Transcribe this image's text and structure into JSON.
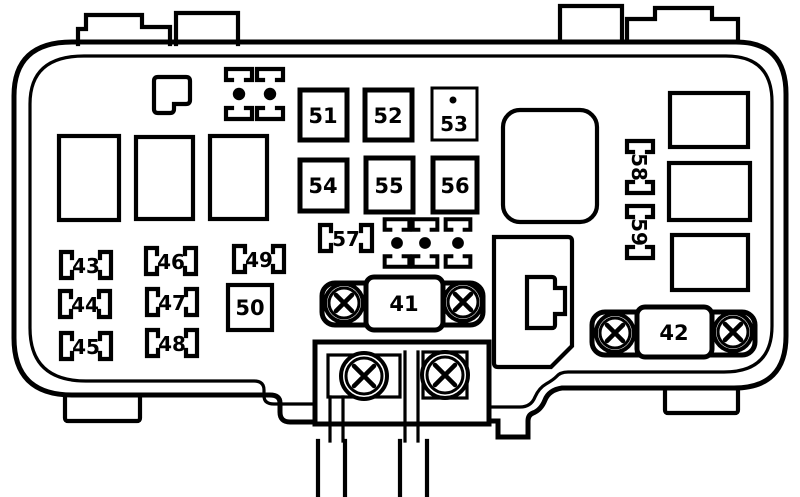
{
  "diagram": {
    "kind": "under-hood fuse and relay box line diagram",
    "line_color": "#000000",
    "background_color": "#ffffff",
    "main_fuses": [
      {
        "label": "41"
      },
      {
        "label": "42"
      }
    ],
    "square_fuses": [
      {
        "label": "50"
      },
      {
        "label": "51"
      },
      {
        "label": "52"
      },
      {
        "label": "53"
      },
      {
        "label": "54"
      },
      {
        "label": "55"
      },
      {
        "label": "56"
      }
    ],
    "bracket_fuses": [
      {
        "label": "43"
      },
      {
        "label": "44"
      },
      {
        "label": "45"
      },
      {
        "label": "46"
      },
      {
        "label": "47"
      },
      {
        "label": "48"
      },
      {
        "label": "49"
      },
      {
        "label": "57"
      }
    ],
    "side_fuses": [
      {
        "label": "58"
      },
      {
        "label": "59"
      }
    ]
  }
}
